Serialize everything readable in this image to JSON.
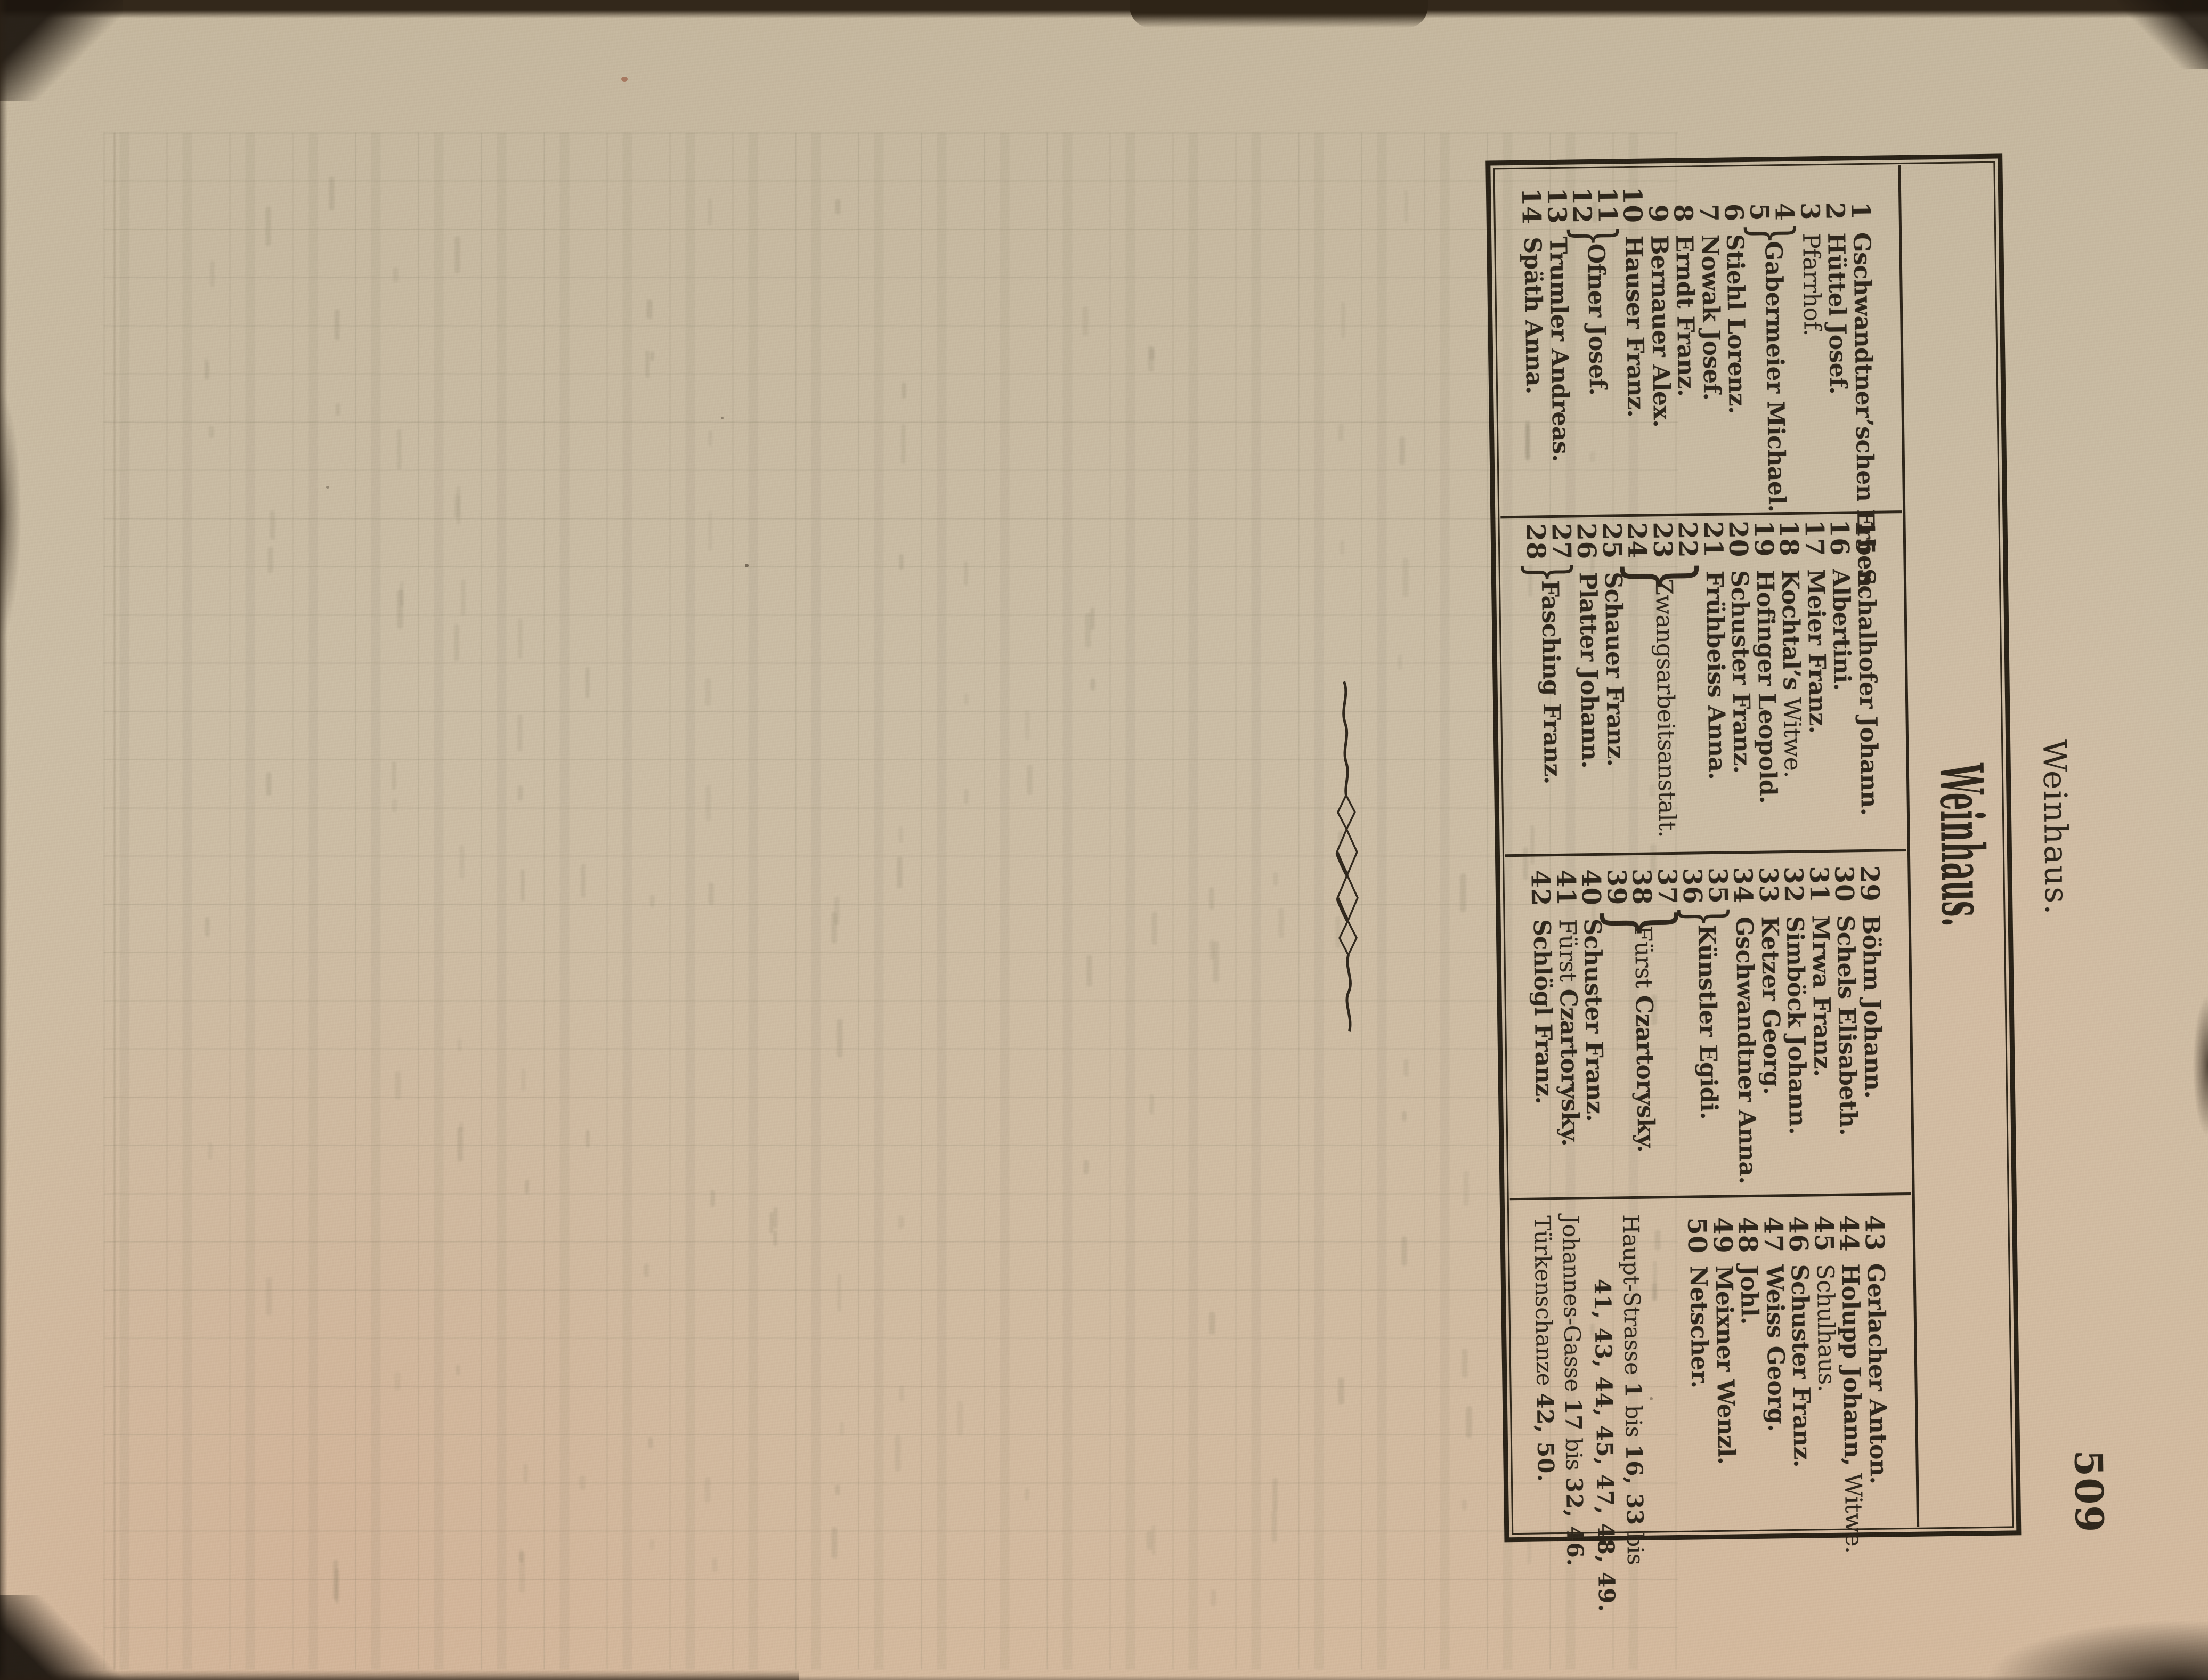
{
  "page": {
    "folio": "509",
    "running_header": "Weinhaus.",
    "title": "Weinhaus."
  },
  "directory": {
    "columns": [
      {
        "entries": [
          {
            "nums": [
              "1"
            ],
            "bold": "Gschwandtner’schen Erben."
          },
          {
            "nums": [
              "2"
            ],
            "bold": "Hüttel Josef."
          },
          {
            "nums": [
              "3"
            ],
            "regular": "Pfarrhof."
          },
          {
            "nums": [
              "4",
              "5"
            ],
            "bold": "Gabermeier Michael."
          },
          {
            "nums": [
              "6"
            ],
            "bold": "Stiehl Lorenz."
          },
          {
            "nums": [
              "7"
            ],
            "bold": "Nowak Josef."
          },
          {
            "nums": [
              "8"
            ],
            "bold": "Erndt Franz."
          },
          {
            "nums": [
              "9"
            ],
            "bold": "Bernauer Alex."
          },
          {
            "nums": [
              "10"
            ],
            "bold": "Hauser Franz."
          },
          {
            "nums": [
              "11",
              "12"
            ],
            "bold": "Ofner Josef."
          },
          {
            "nums": [
              "13"
            ],
            "bold": "Trumler Andreas."
          },
          {
            "nums": [
              "14"
            ],
            "bold": "Späth Anna."
          }
        ]
      },
      {
        "entries": [
          {
            "nums": [
              "15"
            ],
            "bold": "Schalhofer Johann."
          },
          {
            "nums": [
              "16"
            ],
            "bold": "Albertini."
          },
          {
            "nums": [
              "17"
            ],
            "bold": "Meier Franz."
          },
          {
            "nums": [
              "18"
            ],
            "bold": "Kochtal’s",
            "regular_suffix": " Witwe."
          },
          {
            "nums": [
              "19"
            ],
            "bold": "Hofinger Leopold."
          },
          {
            "nums": [
              "20"
            ],
            "bold": "Schuster Franz."
          },
          {
            "nums": [
              "21"
            ],
            "bold": "Frühbeiss Anna."
          },
          {
            "nums": [
              "22",
              "23",
              "24"
            ],
            "regular": "Zwangsarbeitsanstalt."
          },
          {
            "nums": [
              "25"
            ],
            "bold": "Schauer Franz."
          },
          {
            "nums": [
              "26"
            ],
            "bold": "Platter Johann."
          },
          {
            "nums": [
              "27",
              "28"
            ],
            "bold": "Fasching Franz."
          }
        ]
      },
      {
        "entries": [
          {
            "nums": [
              "29"
            ],
            "bold": "Böhm Johann."
          },
          {
            "nums": [
              "30"
            ],
            "bold": "Schels Elisabeth."
          },
          {
            "nums": [
              "31"
            ],
            "bold": "Mrwa Franz."
          },
          {
            "nums": [
              "32"
            ],
            "bold": "Simböck Johann."
          },
          {
            "nums": [
              "33"
            ],
            "bold": "Ketzer Georg."
          },
          {
            "nums": [
              "34"
            ],
            "bold": "Gschwandtner Anna."
          },
          {
            "nums": [
              "35",
              "36"
            ],
            "bold": "Künstler Egidi."
          },
          {
            "nums": [
              "37",
              "38",
              "39"
            ],
            "regular_prefix": "Fürst ",
            "bold": "Czartorysky."
          },
          {
            "nums": [
              "40"
            ],
            "bold": "Schuster Franz."
          },
          {
            "nums": [
              "41"
            ],
            "regular_prefix": "Fürst ",
            "bold": "Czartorysky."
          },
          {
            "nums": [
              "42"
            ],
            "bold": "Schlögl Franz."
          }
        ]
      },
      {
        "entries": [
          {
            "nums": [
              "43"
            ],
            "bold": "Gerlacher Anton."
          },
          {
            "nums": [
              "44"
            ],
            "bold": "Holupp Johann,",
            "regular_suffix": " Witwe."
          },
          {
            "nums": [
              "45"
            ],
            "regular": "Schulhaus."
          },
          {
            "nums": [
              "46"
            ],
            "bold": "Schuster Franz."
          },
          {
            "nums": [
              "47"
            ],
            "bold": "Weiss Georg."
          },
          {
            "nums": [
              "48"
            ],
            "bold": "Johl."
          },
          {
            "nums": [
              "49"
            ],
            "bold": "Meixner Wenzl."
          },
          {
            "nums": [
              "50"
            ],
            "bold": "Netscher."
          }
        ]
      }
    ],
    "streets": [
      {
        "indent": false,
        "parts": [
          [
            "Haupt-Strasse ",
            0
          ],
          [
            "1",
            1
          ],
          [
            " bis ",
            0
          ],
          [
            "16, 33",
            1
          ],
          [
            " bis",
            0
          ]
        ]
      },
      {
        "indent": true,
        "parts": [
          [
            "41, 43, 44, 45, 47, 48, 49.",
            1
          ]
        ]
      },
      {
        "indent": false,
        "parts": [
          [
            "Johannes-Gasse ",
            0
          ],
          [
            "17",
            1
          ],
          [
            " bis ",
            0
          ],
          [
            "32, 46.",
            1
          ]
        ]
      },
      {
        "indent": false,
        "parts": [
          [
            "Türkenschanze ",
            0
          ],
          [
            "42, 50.",
            1
          ]
        ]
      }
    ]
  }
}
